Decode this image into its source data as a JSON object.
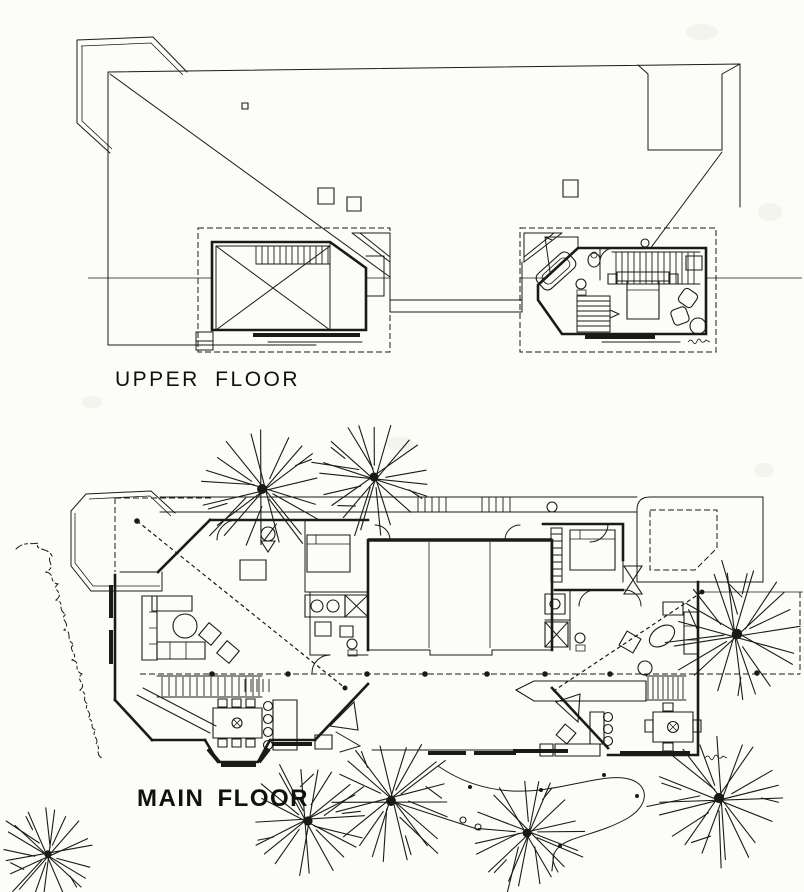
{
  "labels": {
    "upper_floor": "UPPER FLOOR",
    "main_floor": "MAIN FLOOR"
  },
  "colors": {
    "paper": "#fcfcf9",
    "ink": "#1a1a1a"
  }
}
